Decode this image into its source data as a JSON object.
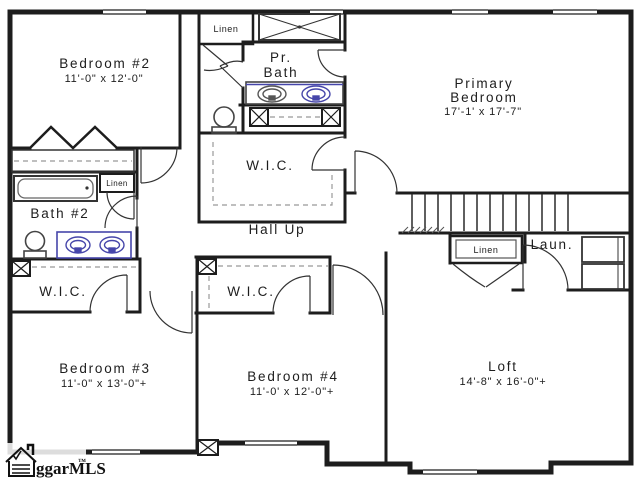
{
  "meta": {
    "type": "floor-plan",
    "background": "#ffffff",
    "wall_color": "#1d1d1d",
    "fixture_accent": "#4646aa"
  },
  "watermark": {
    "text": "ggarMLS",
    "tm": "™"
  },
  "rooms": {
    "bedroom2": {
      "label": "Bedroom #2",
      "dims": "11'-0\" x 12'-0\""
    },
    "primary_bedroom": {
      "line1": "Primary",
      "line2": "Bedroom",
      "dims": "17'-1' x 17'-7\""
    },
    "pr_bath": {
      "line1": "Pr.",
      "line2": "Bath"
    },
    "bath2": {
      "label": "Bath #2"
    },
    "wic_primary": {
      "label": "W.I.C."
    },
    "wic_bedroom3": {
      "label": "W.I.C."
    },
    "wic_bedroom4": {
      "label": "W.I.C."
    },
    "hall": {
      "label": "Hall Up"
    },
    "linen_top": {
      "label": "Linen"
    },
    "linen_bath2": {
      "label": "Linen"
    },
    "linen_hall": {
      "label": "Linen"
    },
    "laundry": {
      "label": "Laun."
    },
    "bedroom3": {
      "label": "Bedroom #3",
      "dims": "11'-0\" x 13'-0\"+"
    },
    "bedroom4": {
      "label": "Bedroom #4",
      "dims": "11'-0' x 12'-0\"+"
    },
    "loft": {
      "label": "Loft",
      "dims": "14'-8\" x 16'-0\"+"
    }
  }
}
